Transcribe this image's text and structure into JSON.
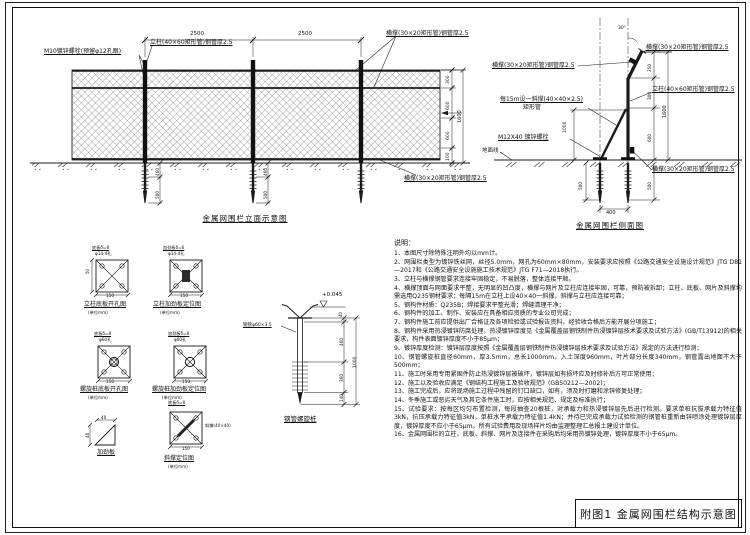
{
  "title_block": {
    "label": "附图1 金属网围栏结构示意图"
  },
  "elevation": {
    "title": "金属网围栏立面示意图"
  },
  "side_view": {
    "title": "金属网围栏侧面图"
  },
  "colors": {
    "line": "#1a1a1a",
    "paper": "#ffffff"
  },
  "notes": {
    "heading": "说明：",
    "lines": [
      "1、本图尺寸除特殊注明外均以mm计。",
      "2、网围栏类型为镀锌铁丝网，丝径5.0mm，网孔为60mm×80mm，安装要求应按照《公路交通安全设施设计规范》JTG D81—2017和《公路交通安全设施施工技术规范》JTG F71—2018执行。",
      "3、立柱与横撑钢管要求连接牢固稳定，不易脱落，整体连接平顺。",
      "4、横撑顶面与网面要求平整，无明显的凹凸度，横撑与网片及立柱应连接牢固，可靠，预防被拆卸；立柱、底板、网片及斜撑均需选用Q235钢材要求；每隔15m在立柱上设40×40一斜撑，斜撑与立柱应连接可靠；",
      "5、钢构件材质：Q235B；焊接要求平整光滑；焊缝清理干净；",
      "6、钢构件的加工、制作、安装应在具备相应资质的专业公司完成；",
      "7、钢构件施工前应提供出厂合格证及各项检验或试验报告资料，经验收合格后方能开展分项施工；",
      "8、钢构件采用热浸镀锌防腐处理，热浸镀锌厚度见《金属覆盖层钢铁制件热浸镀锌层技术要求及试验方法》(GB/T13912)的相关要求，构件表面镀锌厚度不小于85μm；",
      "9、镀锌厚度检测：镀锌层厚度按照《金属覆盖层钢铁制件热浸镀锌层技术要求及试验方法》规定的方法进行检测；",
      "10、钢管螺旋桩直径60mm，厚3.5mm，总长1000mm，入土深度960mm，叶片部分长度340mm，钢管露出地面不大于500mm；",
      "11、施工时采用专用紧固件防止热浸镀锌层被破坏，镀锌层如有损坏应及时修补后方可正常使用；",
      "12、施工以及验收应满足《钢结构工程施工及验收规范》(GB50212—2002)；",
      "13、施工完成后，应将现场施工过程中残留的钉口缺口，如有，须及时打磨和涂锌修复处理；",
      "14、冬季施工或恶劣天气及其它条件施工时，应按相关规范、规定及标准执行；",
      "15、试验要求：按每区均匀布置检测，每段抽查20根桩，对承载力和热浸镀锌层先后进行检测。要求单桩抗拔承载力特征值3kN，抗压承载力特征值3kN，单桩水平承载力特征值1.4kN；并待已完成承载力试验检测的钢管桩重新由锌喷涂处理镀锌层厚度，镀锌厚度不应小于65μm。所有试验费用及现场样片均由监理整理汇总报土建设计单位。",
      "16、金属网围栏的立柱、底板、斜撑、网片及连接件在采购后均采用热镀锌处理，镀锌厚度不小于65μm。"
    ]
  },
  "annotations": [
    {
      "n": "label-m10-bolt",
      "t": "M10镀锌螺栓(预留φ12孔眼)",
      "x": 44,
      "y": 49,
      "fs": 6,
      "u": 1
    },
    {
      "n": "label-post-elevation",
      "t": "立柱(40×60矩形管)钢管厚2.5",
      "x": 150,
      "y": 40,
      "fs": 6,
      "u": 1
    },
    {
      "n": "label-top-rail-elevation",
      "t": "横撑(30×20矩形管)钢管厚2.5",
      "x": 386,
      "y": 31,
      "fs": 6,
      "u": 1
    },
    {
      "n": "label-bottom-rail-elevation",
      "t": "横撑(30×20矩形管)钢管厚2.5",
      "x": 404,
      "y": 176,
      "fs": 6,
      "u": 1
    },
    {
      "n": "dim-span",
      "t": "2500",
      "x": 190,
      "y": 32,
      "fs": 5.5
    },
    {
      "n": "dim-span",
      "t": "2500",
      "x": 298,
      "y": 32,
      "fs": 5.5
    },
    {
      "n": "dim-height",
      "t": "300",
      "x": 447,
      "y": 84,
      "fs": 4.5,
      "rot": -90
    },
    {
      "n": "dim-height",
      "t": "600",
      "x": 447,
      "y": 110,
      "fs": 4.5,
      "rot": -90
    },
    {
      "n": "dim-height",
      "t": "600",
      "x": 447,
      "y": 140,
      "fs": 4.5,
      "rot": -90
    },
    {
      "n": "dim-height",
      "t": "100",
      "x": 447,
      "y": 161,
      "fs": 4.5,
      "rot": -90
    },
    {
      "n": "dim-total-height",
      "t": "1600",
      "x": 458,
      "y": 123,
      "fs": 5,
      "rot": -90
    },
    {
      "n": "dim-pile",
      "t": "460",
      "x": 156,
      "y": 176,
      "fs": 4.2,
      "rot": -90
    },
    {
      "n": "dim-pile",
      "t": "500",
      "x": 156,
      "y": 199,
      "fs": 4.2,
      "rot": -90
    },
    {
      "n": "dim-pile",
      "t": "460",
      "x": 264,
      "y": 176,
      "fs": 4.2,
      "rot": -90
    },
    {
      "n": "dim-pile",
      "t": "500",
      "x": 264,
      "y": 199,
      "fs": 4.2,
      "rot": -90
    },
    {
      "n": "label-top-rail-side",
      "t": "横撑(30×20矩形管)钢管厚2.5",
      "x": 646,
      "y": 45,
      "fs": 6,
      "u": 1
    },
    {
      "n": "label-left-rail-side",
      "t": "横撑(30×20矩形管)钢管厚2.5",
      "x": 492,
      "y": 63,
      "fs": 6,
      "u": 1
    },
    {
      "n": "label-post-side",
      "t": "立柱(40×60矩形管)钢管厚2.5",
      "x": 652,
      "y": 87,
      "fs": 6,
      "u": 1
    },
    {
      "n": "label-brace-side",
      "t": "每15m设一斜撑(40×40×2.5)",
      "x": 500,
      "y": 97,
      "fs": 6,
      "u": 1
    },
    {
      "n": "label-brace-side-2",
      "t": "矩形管",
      "x": 523,
      "y": 105,
      "fs": 6
    },
    {
      "n": "label-m12-bolt",
      "t": "M12X40 镀锌螺栓",
      "x": 498,
      "y": 135,
      "fs": 6,
      "u": 1
    },
    {
      "n": "label-bottom-rail-side",
      "t": "横撑(30×20矩形管)钢管厚2.5",
      "x": 652,
      "y": 167,
      "fs": 6,
      "u": 1
    },
    {
      "n": "label-ground-line",
      "t": "地面线",
      "x": 482,
      "y": 149,
      "fs": 5.5
    },
    {
      "n": "dim-angle",
      "t": "30°",
      "x": 618,
      "y": 27,
      "fs": 4.5
    },
    {
      "n": "dim-span",
      "t": "400",
      "x": 606,
      "y": 211,
      "fs": 5
    },
    {
      "n": "dim-height",
      "t": "1000",
      "x": 564,
      "y": 133,
      "fs": 4.5,
      "rot": -90
    },
    {
      "n": "dim-pile",
      "t": "500",
      "x": 579,
      "y": 190,
      "fs": 4.2,
      "rot": -90
    },
    {
      "n": "dim-height",
      "t": "250",
      "x": 648,
      "y": 72,
      "fs": 4.2,
      "rot": -90
    },
    {
      "n": "dim-height",
      "t": "300",
      "x": 648,
      "y": 100,
      "fs": 4.2,
      "rot": -90
    },
    {
      "n": "dim-height",
      "t": "600",
      "x": 648,
      "y": 142,
      "fs": 4.2,
      "rot": -90
    },
    {
      "n": "dim-pile",
      "t": "500",
      "x": 648,
      "y": 190,
      "fs": 4.2,
      "rot": -90
    },
    {
      "n": "dim-total-height",
      "t": "1600",
      "x": 663,
      "y": 118,
      "fs": 5,
      "rot": -90
    },
    {
      "n": "detail-title-post-baseplate",
      "t": "立柱底板开孔图",
      "x": 84,
      "y": 302,
      "fs": 6,
      "u": 1
    },
    {
      "n": "detail-scale",
      "t": "(单位mm)",
      "x": 88,
      "y": 311,
      "fs": 4.2
    },
    {
      "n": "detail-title-post-stiffener",
      "t": "立柱加劲板定位图",
      "x": 153,
      "y": 302,
      "fs": 6,
      "u": 1
    },
    {
      "n": "detail-scale",
      "t": "(单位mm)",
      "x": 160,
      "y": 311,
      "fs": 4.2
    },
    {
      "n": "detail-title-pile-baseplate",
      "t": "螺旋桩底板开孔图",
      "x": 80,
      "y": 387,
      "fs": 6,
      "u": 1
    },
    {
      "n": "detail-scale",
      "t": "(单位mm)",
      "x": 88,
      "y": 396,
      "fs": 4.2
    },
    {
      "n": "detail-title-pile-stiffener",
      "t": "螺旋桩加劲板定位图",
      "x": 152,
      "y": 387,
      "fs": 6,
      "u": 1
    },
    {
      "n": "detail-scale",
      "t": "(单位mm)",
      "x": 162,
      "y": 396,
      "fs": 4.2
    },
    {
      "n": "detail-title-stiffener-plate",
      "t": "加劲板",
      "x": 97,
      "y": 450,
      "fs": 6,
      "u": 1
    },
    {
      "n": "detail-title-brace-location",
      "t": "斜撑定位图",
      "x": 164,
      "y": 456,
      "fs": 6,
      "u": 1
    },
    {
      "n": "detail-scale",
      "t": "(单位mm)",
      "x": 168,
      "y": 465,
      "fs": 4.2
    },
    {
      "n": "detail-title-screw-pile",
      "t": "钢管螺旋桩",
      "x": 284,
      "y": 416,
      "fs": 6.5,
      "u": 1
    },
    {
      "n": "tiny-label",
      "t": "底板δ=8",
      "x": 92,
      "y": 246,
      "fs": 4.2,
      "u": 1
    },
    {
      "n": "tiny-label",
      "t": "φ14-4孔",
      "x": 95,
      "y": 252,
      "fs": 4.2
    },
    {
      "n": "tiny-label",
      "t": "加劲板δ=6",
      "x": 163,
      "y": 246,
      "fs": 4.2,
      "u": 1
    },
    {
      "n": "tiny-label",
      "t": "φ14-4孔",
      "x": 168,
      "y": 252,
      "fs": 4.2
    },
    {
      "n": "dim-detail",
      "t": "150",
      "x": 106,
      "y": 294,
      "fs": 4.2
    },
    {
      "n": "dim-detail",
      "t": "150",
      "x": 180,
      "y": 294,
      "fs": 4.2
    },
    {
      "n": "dim-detail",
      "t": "50",
      "x": 86,
      "y": 274,
      "fs": 4,
      "rot": -90
    },
    {
      "n": "tiny-label",
      "t": "底板δ=8",
      "x": 94,
      "y": 332,
      "fs": 4.2,
      "u": 1
    },
    {
      "n": "tiny-label",
      "t": "φ60孔",
      "x": 99,
      "y": 338,
      "fs": 4.2
    },
    {
      "n": "tiny-label",
      "t": "加劲板δ=6",
      "x": 168,
      "y": 332,
      "fs": 4.2,
      "u": 1
    },
    {
      "n": "tiny-label",
      "t": "φ60孔",
      "x": 174,
      "y": 338,
      "fs": 4.2
    },
    {
      "n": "dim-detail",
      "t": "150",
      "x": 106,
      "y": 380,
      "fs": 4.2
    },
    {
      "n": "dim-detail",
      "t": "150",
      "x": 182,
      "y": 380,
      "fs": 4.2
    },
    {
      "n": "dim-detail",
      "t": "40",
      "x": 101,
      "y": 416,
      "fs": 4.2
    },
    {
      "n": "dim-detail",
      "t": "40",
      "x": 86,
      "y": 438,
      "fs": 4.2,
      "rot": -90
    },
    {
      "n": "tiny-label",
      "t": "底板δ=8",
      "x": 168,
      "y": 401,
      "fs": 4.2,
      "u": 1
    },
    {
      "n": "tiny-label",
      "t": "斜撑(40×40)",
      "x": 205,
      "y": 424,
      "fs": 4.2
    },
    {
      "n": "dim-detail",
      "t": "150",
      "x": 182,
      "y": 447,
      "fs": 4
    },
    {
      "n": "elevation-mark",
      "t": "+0.045",
      "x": 322,
      "y": 293,
      "fs": 5.5
    },
    {
      "n": "label-pipe-spec",
      "t": "钢管φ60×3.5",
      "x": 243,
      "y": 324,
      "fs": 4.5,
      "u": 1
    },
    {
      "n": "dim-pile-detail",
      "t": "40",
      "x": 339,
      "y": 317,
      "fs": 4,
      "rot": -90
    },
    {
      "n": "dim-pile-detail",
      "t": "460",
      "x": 340,
      "y": 346,
      "fs": 4.2,
      "rot": -90
    },
    {
      "n": "dim-pile-detail",
      "t": "360",
      "x": 340,
      "y": 382,
      "fs": 4.2,
      "rot": -90
    },
    {
      "n": "dim-pile-detail",
      "t": "140",
      "x": 340,
      "y": 402,
      "fs": 4.2,
      "rot": -90
    },
    {
      "n": "dim-pile-detail",
      "t": "1000",
      "x": 354,
      "y": 368,
      "fs": 4.5,
      "rot": -90
    }
  ]
}
